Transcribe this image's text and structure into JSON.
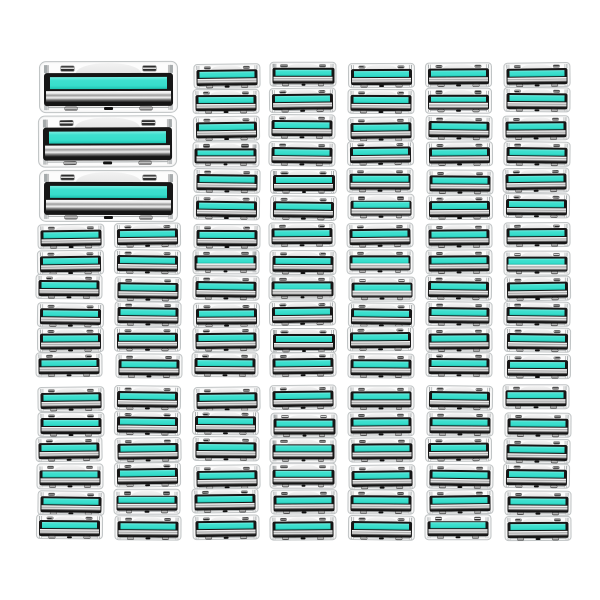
{
  "product_image": {
    "description": "E-commerce style product photo: twin-blade razor refill cartridges with teal lubricating strips laid out in rows on a white background",
    "background": "#ffffff",
    "cartridge": {
      "parts": [
        "frame",
        "release-clips",
        "comfort-dome",
        "lubricant-strip",
        "blade-stack",
        "base-clips",
        "base-connector"
      ],
      "colors": {
        "frame": "#fcfcfc",
        "frame_border": "#c0c4c5",
        "body": "#161616",
        "lubricant_strip": "#3ee0cf",
        "blade_highlight": "#f8f8f8",
        "blade_shadow": "#515151",
        "clip": "#2e2e2e"
      }
    },
    "groups": [
      {
        "id": "large-stack",
        "type": "stack",
        "item": "large",
        "columns": 1,
        "rows": 3
      },
      {
        "id": "grid-top",
        "type": "grid",
        "item": "small",
        "columns": 5,
        "rows": 6
      },
      {
        "id": "grid-middle",
        "type": "grid",
        "item": "small",
        "columns": 7,
        "rows": 6
      },
      {
        "id": "grid-bottom",
        "type": "grid",
        "item": "small",
        "columns": 7,
        "rows": 6
      }
    ],
    "counts": {
      "large_cartridges": 3,
      "small_cartridges": 114,
      "total": 117
    }
  }
}
